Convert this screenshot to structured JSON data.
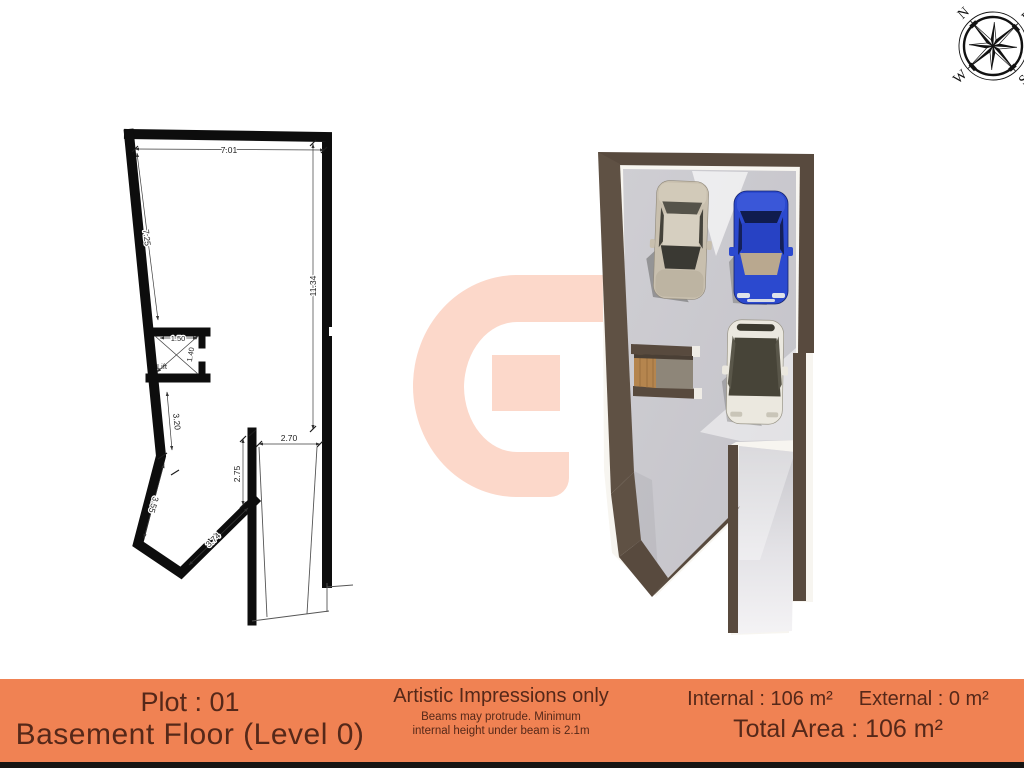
{
  "compass": {
    "n": "N",
    "e": "E",
    "s": "S",
    "w": "W"
  },
  "plan2d": {
    "dim_top": "7.01",
    "dim_left": "7.25",
    "dim_right": "11.34",
    "lift_width": "1.50",
    "lift_depth": "1.40",
    "lift_label": "Lift",
    "dim_wall_a": "3.20",
    "dim_wall_b": "3.55",
    "dim_wall_c": "3.74",
    "dim_ramp_h": "2.75",
    "dim_ramp_w": "2.70"
  },
  "footer": {
    "plot": "Plot : 01",
    "floor": "Basement Floor (Level 0)",
    "disclaimer_title": "Artistic Impressions only",
    "disclaimer_l1": "Beams may protrude. Minimum",
    "disclaimer_l2": "internal height under beam is 2.1m",
    "internal": "Internal : 106 m²",
    "external": "External : 0 m²",
    "total": "Total Area : 106 m²"
  },
  "colors": {
    "footer_orange": "#f08253",
    "footer_text": "#552819",
    "watermark_pink": "#fcd8ca",
    "wall_3d": "#584a3e",
    "plan_black": "#0d0d0d",
    "floor_gray": "#c9c8cd"
  }
}
